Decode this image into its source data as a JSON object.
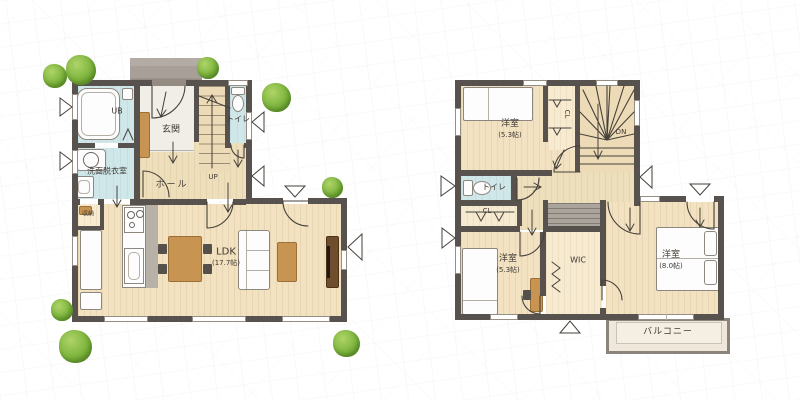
{
  "document": {
    "kind": "house-floor-plan",
    "floors": [
      "first-floor",
      "second-floor"
    ]
  },
  "colors": {
    "wall": "#57524d",
    "wood_floor": "#f2e2c1",
    "wet_room": "#cfe7e9",
    "closet_floor": "#f6ead0",
    "porch_gray": "#a8a098",
    "tree_green": "#7db43d",
    "furniture_wood": "#c79452",
    "tv_board": "#6e4e2c",
    "stair_wood": "#ecdbb6",
    "balcony_floor": "#efe8da"
  },
  "floor1": {
    "labels": {
      "ub": "UB",
      "genkan": "玄関",
      "toilet": "トイレ",
      "washroom": "洗面脱衣室",
      "hall": "ホール",
      "up": "UP",
      "storage": "収納",
      "ldk": "LDK",
      "ldk_area": "(17.7帖)"
    }
  },
  "floor2": {
    "labels": {
      "bedroom_a": "洋室",
      "bedroom_a_area": "(5.3帖)",
      "closet_a": "CL",
      "down": "DN",
      "toilet": "トイレ",
      "closet_b": "CL",
      "bedroom_b": "洋室",
      "bedroom_b_area": "(5.3帖)",
      "wic": "WIC",
      "bedroom_c": "洋室",
      "bedroom_c_area": "(8.0帖)",
      "balcony": "バルコニー"
    }
  }
}
